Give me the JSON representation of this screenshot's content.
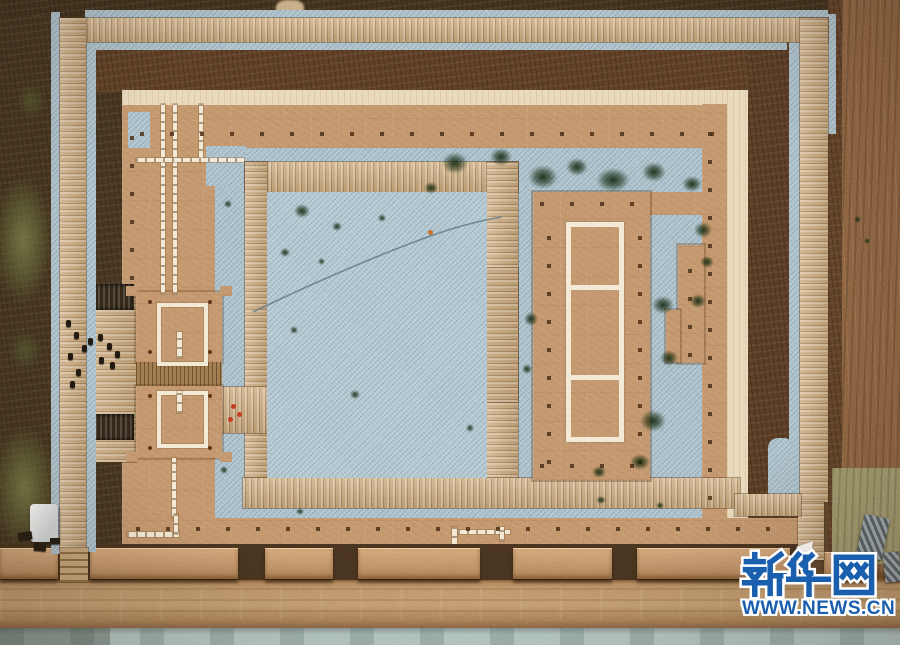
{
  "image": {
    "type": "aerial-drone-photograph",
    "subject": "Top-down view of an archaeological ruin site: rectangular rammed-earth walled compound covered with protective blue-grey gravel, a three-bay hall foundation outlined in white on an eastern earthen platform, a west gate complex with two square tower footprints, reconstructed wall blocks along the south side, wooden visitor boardwalks around and through the site, a dirt road and a pale water channel along the bottom edge",
    "orientation": "top-down"
  },
  "watermark": {
    "brand": "新华网",
    "brand_latin": "Xinhuanet",
    "url": "WWW.NEWS.CN",
    "text_color": "#1a5fae",
    "outline_color": "#ffffff"
  },
  "features": {
    "outer_boardwalk": "wooden walkway loop on left, top and right perimeter with steps to the road",
    "compound_wall": "earthen wall band with pale capping stripe on north and east sides",
    "courtyard": "large gravel-covered inner courtyard framed by boardwalks",
    "main_hall_platform": "eastern tan platform with white-bordered three-cell foundation trench",
    "west_gate": "gate complex with two white-outlined square structures and plank passage",
    "excavation_marks": "white dotted trench marker lines and post holes",
    "south_wall_blocks": "row of raised wall segments along the south edge",
    "road": "dirt road along the bottom",
    "water_channel": "light grey water strip at bottom edge",
    "visitors": "small groups of people on the west boardwalk",
    "tent": "white canopy at the south-west corner"
  },
  "colors": {
    "earth-dark": "#44331f",
    "earth-mid": "#5a452c",
    "earth-red": "#5b3d24",
    "earth-right": "#8a6140",
    "gravel": "#a7bdc8",
    "gravel-bright": "#aec4cf",
    "wood": "#c9a678",
    "cream": "#e9d8ba",
    "tan": "#c09168",
    "road": "#b98f63",
    "water": "#b5c9c5",
    "white-line": "#f2e9d4",
    "blue": "#1a5fae"
  }
}
